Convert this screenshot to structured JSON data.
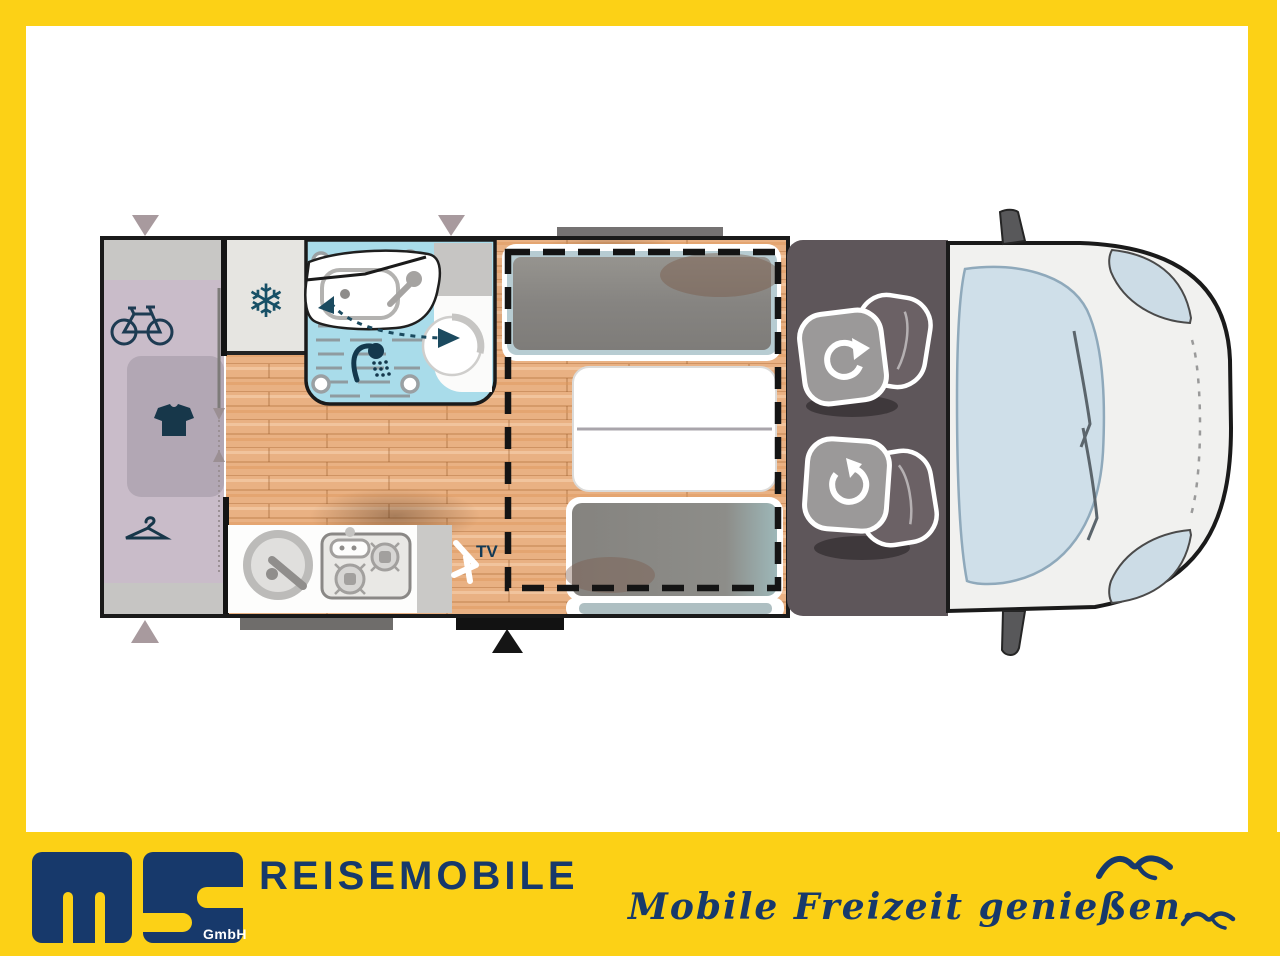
{
  "branding": {
    "logo_text": "ms",
    "gmbh": "GmbH",
    "company": "REISEMOBILE",
    "slogan": "Mobile Freizeit genießen."
  },
  "floorplan": {
    "tv_label": "TV",
    "snowflake_glyph": "❄",
    "zones": [
      "rear-garage-bike-storage",
      "wardrobe",
      "fridge",
      "bathroom",
      "kitchen",
      "dinette-with-bed-outline",
      "swivel-cab-seats",
      "vehicle-cab-front"
    ],
    "icons": [
      "bicycle-icon",
      "tshirt-icon",
      "hanger-icon",
      "snowflake-icon",
      "shower-icon",
      "sink-icon",
      "toilet-icon",
      "kitchen-sink-icon",
      "stove-icon",
      "tv-icon",
      "swivel-arrow-icon",
      "door-marker-triangle",
      "seagull-icon"
    ]
  },
  "colors": {
    "frame_yellow": "#fcd116",
    "brand_navy": "#17396b",
    "icon_navy": "#17374a",
    "wood_floor": "#e9b183",
    "garage_lavender": "#c9bcc9",
    "garage_panel": "#b2a7b4",
    "bathroom_blue": "#a9dcea",
    "fridge_gray": "#e6e5e1",
    "cab_dark": "#5e565a",
    "seat_base_gray": "#9b9999",
    "seat_back_gray": "#6b6165",
    "cushion_gray": "#8a8886",
    "cushion_frame_blue": "#b7ccd2",
    "windshield_blue": "#cfdfe9",
    "vehicle_white": "#f1f1ef",
    "step_black": "#121212",
    "step_gray": "#6f6d6b",
    "swivel_teal": "#1b4a5f"
  }
}
